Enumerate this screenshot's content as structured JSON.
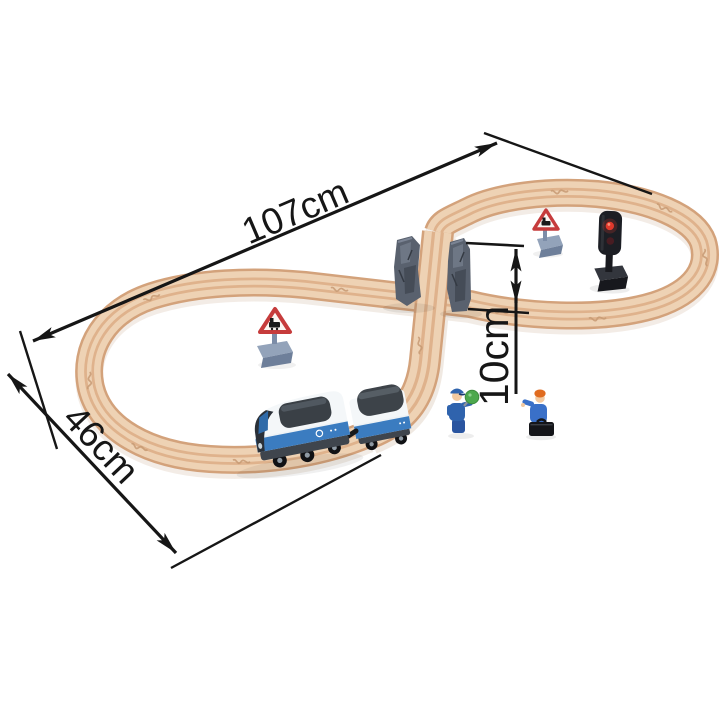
{
  "annotations": {
    "length": {
      "label": "107cm"
    },
    "width": {
      "label": "46cm"
    },
    "height": {
      "label": "10cm"
    }
  },
  "objects": {
    "track": "figure-eight-wooden-track",
    "bridge": "rock-pier-crossing",
    "train": [
      "locomotive",
      "luggage-wagon"
    ],
    "figures": [
      "conductor-with-signal-paddle",
      "passenger-with-suitcase"
    ],
    "accessories": [
      "warning-sign-left",
      "warning-sign-right",
      "signal-light"
    ]
  },
  "colors": {
    "background": "#ffffff",
    "wood_edge": "#d3a27b",
    "wood_surface": "#eed2b4",
    "wood_groove": "#dfb28c",
    "annotation": "#161616",
    "train_blue": "#3b7cc0",
    "train_white": "#f4f7f9",
    "window_tint": "#3a4046",
    "pier_gray": "#59616e",
    "sign_red": "#c63c3c",
    "sign_base_gray": "#8b9cb5",
    "signal_body": "#1c1e24",
    "signal_red": "#e0392c",
    "paddle_green": "#4da84d"
  }
}
